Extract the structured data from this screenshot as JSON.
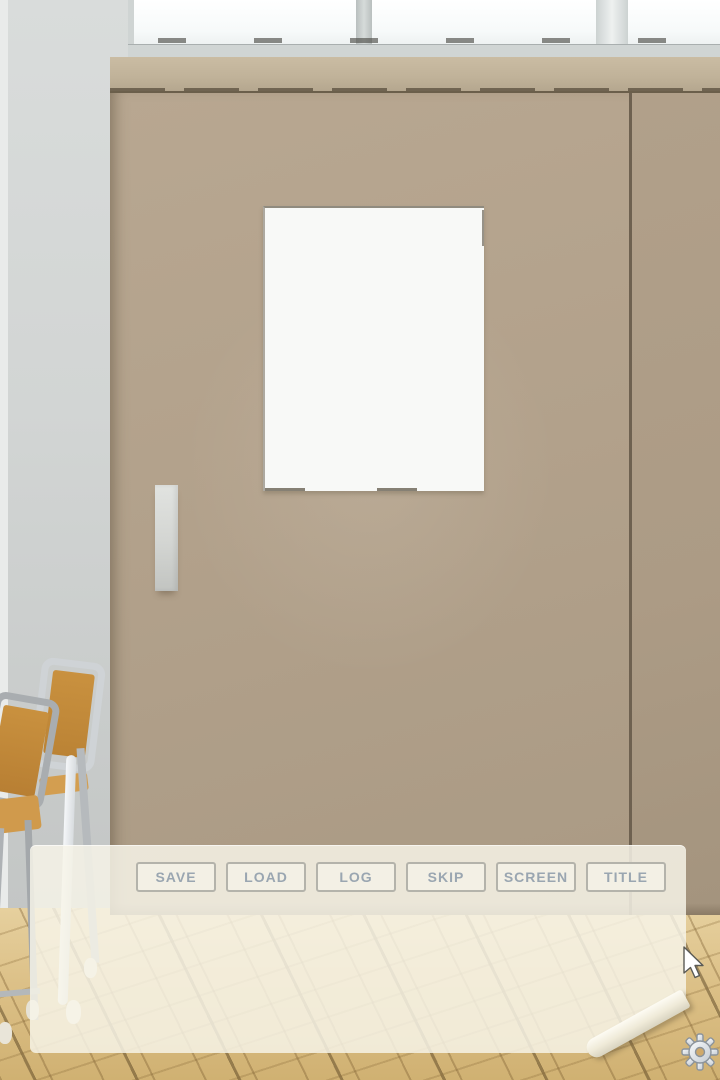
{
  "menu": {
    "buttons": [
      {
        "label": "SAVE"
      },
      {
        "label": "LOAD"
      },
      {
        "label": "LOG"
      },
      {
        "label": "SKIP"
      },
      {
        "label": "SCREEN"
      },
      {
        "label": "TITLE"
      }
    ],
    "text_color": "#9aa6b1",
    "button_bg": "#f2f0e5",
    "button_border": "#b4b3ab"
  },
  "dialog": {
    "text": ""
  },
  "icons": {
    "settings": "gear-icon",
    "pointer": "arrow-cursor"
  },
  "palette": {
    "door": "#b2a18b",
    "door_rail": "#c0b299",
    "wall": "#d2d5d4",
    "floor": "#dcc087",
    "paper": "#f6f3e7",
    "window": "#fbfdfc",
    "chair_wood": "#c9913f",
    "chair_metal": "#b6babd"
  },
  "cursor": {
    "x": 697,
    "y": 966
  }
}
